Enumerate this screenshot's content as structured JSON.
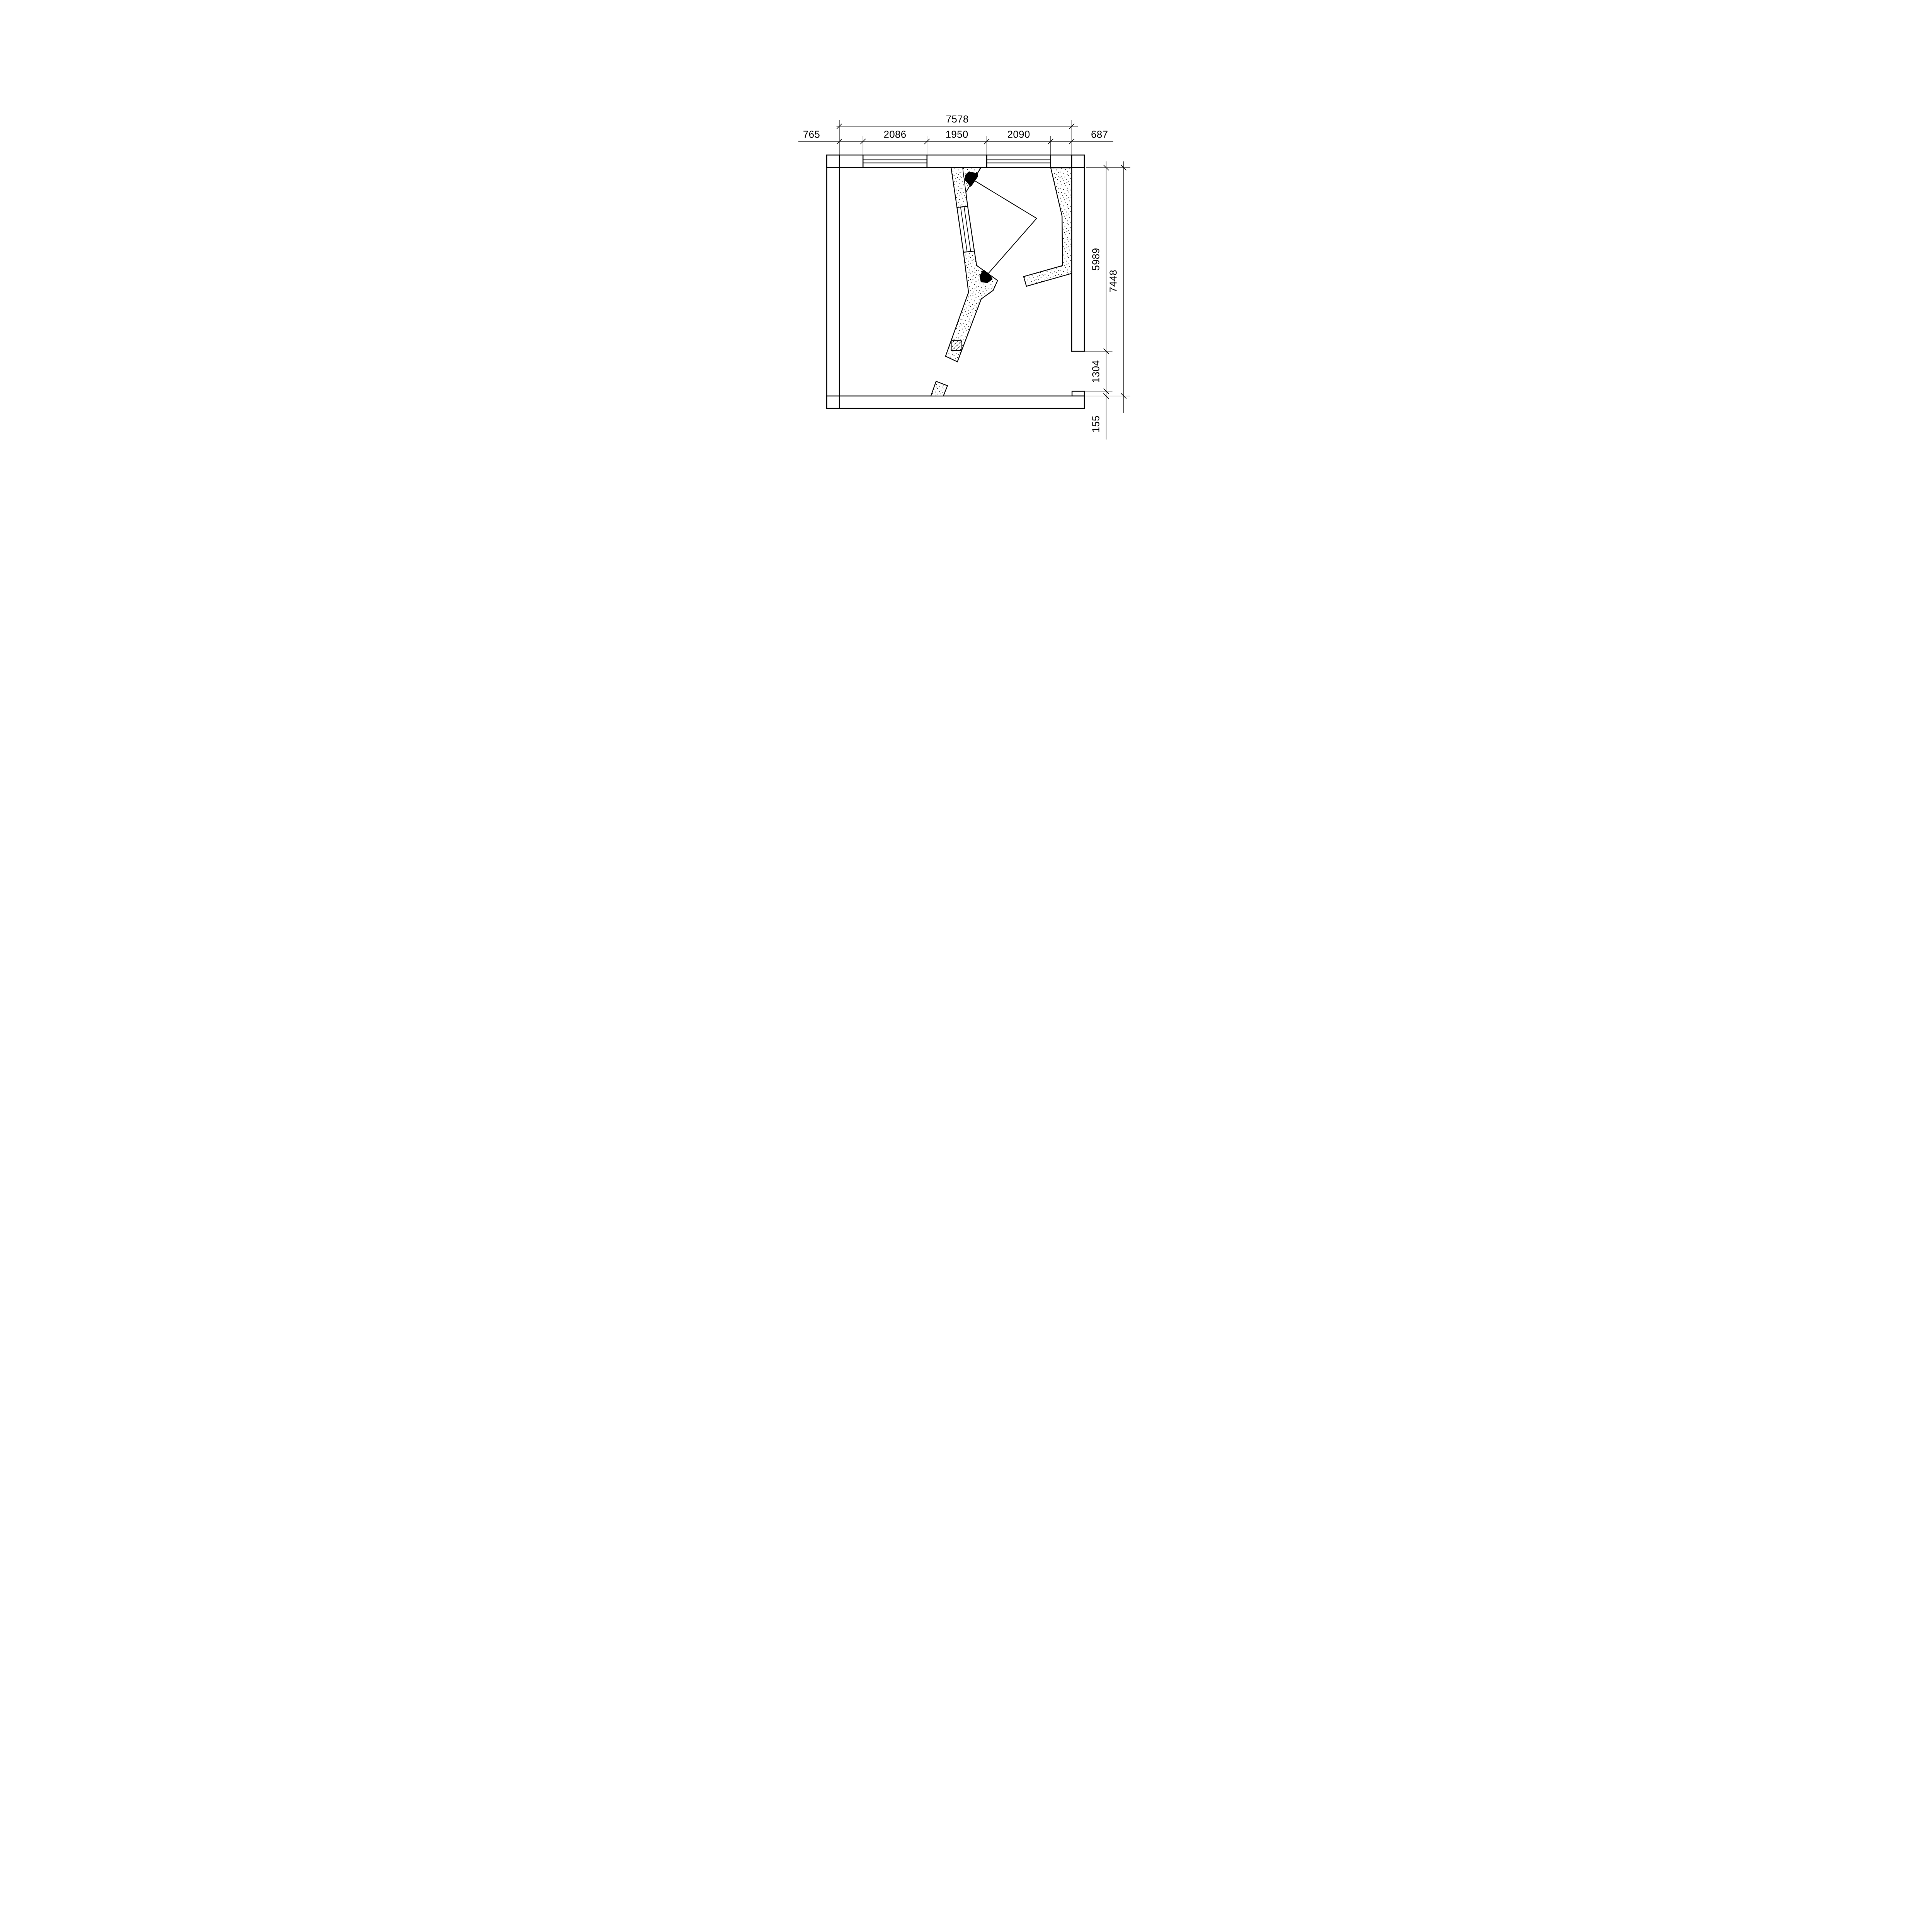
{
  "drawing_title": "floor-plan",
  "dimensions": {
    "top": {
      "total": "7578",
      "chain": [
        "765",
        "2086",
        "1950",
        "2090",
        "687"
      ]
    },
    "right": {
      "total": "7448",
      "chain": [
        "5989",
        "1304",
        "155"
      ]
    }
  },
  "colors": {
    "line": "#000000",
    "background": "#ffffff"
  },
  "symbols": {
    "wall_hatch": "diagonal-hatch",
    "interior_wall_fill": "stipple-dots",
    "column_fill": "dash-dot-hatch",
    "view_marker": "black-wedge"
  }
}
